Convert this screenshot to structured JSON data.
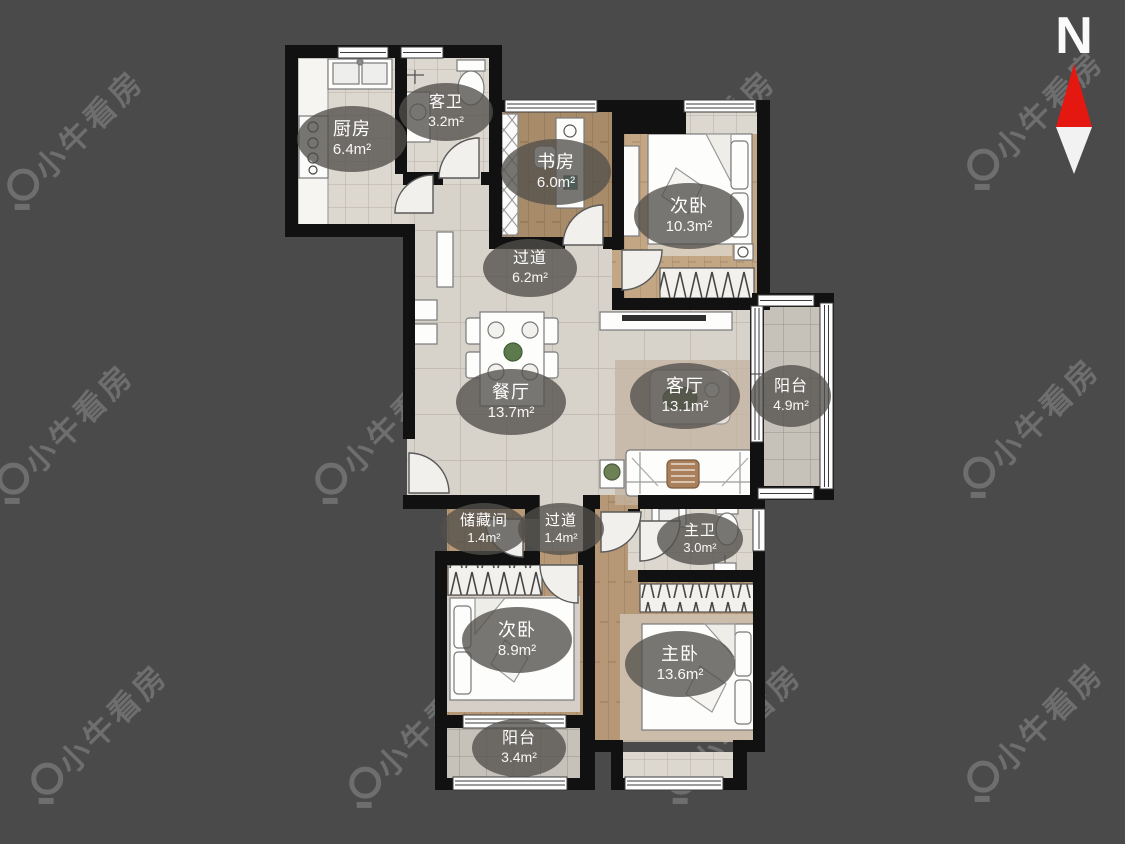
{
  "floorplan": {
    "watermark": {
      "text": "小牛看房"
    },
    "compass": {
      "label": "N"
    },
    "colors": {
      "background": "#4a4a4a",
      "wall": "#111111",
      "compass_red": "#e41810",
      "compass_white": "#f2f2f2",
      "label_bg": "rgba(82,80,76,0.78)"
    },
    "rooms": [
      {
        "id": "kitchen",
        "name": "厨房",
        "area": "6.4m²"
      },
      {
        "id": "guest-bath",
        "name": "客卫",
        "area": "3.2m²"
      },
      {
        "id": "study",
        "name": "书房",
        "area": "6.0m²"
      },
      {
        "id": "bedroom-north",
        "name": "次卧",
        "area": "10.3m²"
      },
      {
        "id": "hallway-upper",
        "name": "过道",
        "area": "6.2m²"
      },
      {
        "id": "dining",
        "name": "餐厅",
        "area": "13.7m²"
      },
      {
        "id": "living",
        "name": "客厅",
        "area": "13.1m²"
      },
      {
        "id": "balcony-east",
        "name": "阳台",
        "area": "4.9m²"
      },
      {
        "id": "storage",
        "name": "储藏间",
        "area": "1.4m²"
      },
      {
        "id": "hallway-lower",
        "name": "过道",
        "area": "1.4m²"
      },
      {
        "id": "master-bath",
        "name": "主卫",
        "area": "3.0m²"
      },
      {
        "id": "bedroom-south",
        "name": "次卧",
        "area": "8.9m²"
      },
      {
        "id": "master-bedroom",
        "name": "主卧",
        "area": "13.6m²"
      },
      {
        "id": "balcony-south",
        "name": "阳台",
        "area": "3.4m²"
      }
    ]
  }
}
